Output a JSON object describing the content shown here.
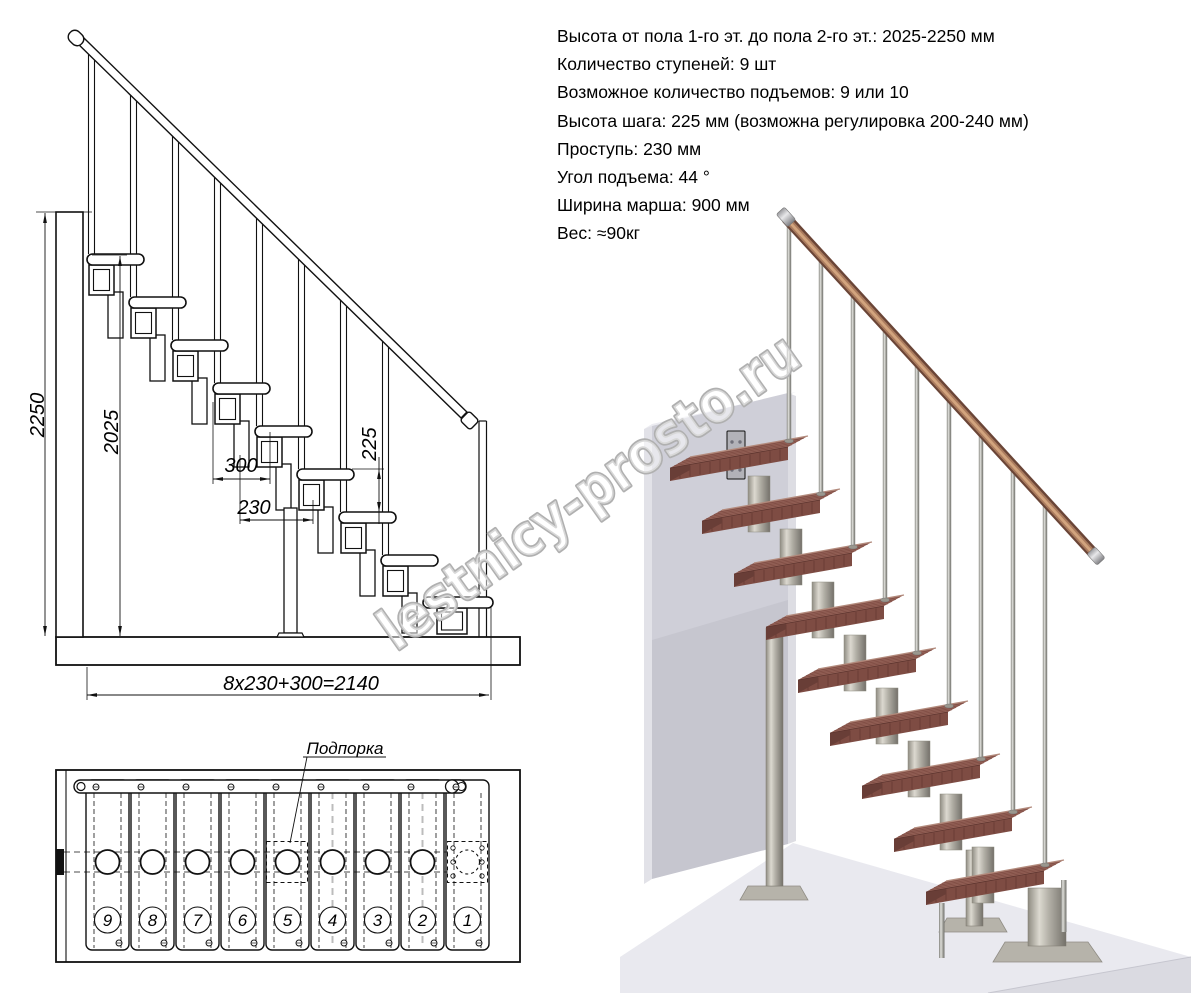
{
  "specs": {
    "lines": [
      "Высота от пола 1-го эт. до пола 2-го эт.: 2025-2250 мм",
      "Количество ступеней: 9 шт",
      "Возможное количество подъемов: 9 или 10",
      "Высота шага: 225 мм (возможна регулировка 200-240 мм)",
      "Проступь: 230 мм",
      "Угол подъема: 44 °",
      "Ширина марша: 900 мм",
      "Вес: ≈90кг"
    ]
  },
  "side_view": {
    "step_count": 9,
    "dim_total_height": "2250",
    "dim_floor_to_top_step": "2025",
    "dim_tread_depth": "300",
    "dim_step_run": "230",
    "dim_step_rise": "225",
    "dim_total_run": "8x230+300=2140"
  },
  "top_view": {
    "support_label": "Подпорка",
    "step_numbers": [
      "9",
      "8",
      "7",
      "6",
      "5",
      "4",
      "3",
      "2",
      "1"
    ]
  },
  "watermark": {
    "text": "lestnicy-prosto.ru"
  },
  "colors": {
    "line": "#111111",
    "tread_wood": "#9b695e",
    "tread_front": "#7e4c43",
    "handrail_wood": "#b07a5c",
    "metal": "#b3b0a7",
    "wall": "#cfcfd8",
    "floor": "#e9e9ef",
    "watermark_gray": "#b0b0b0"
  }
}
